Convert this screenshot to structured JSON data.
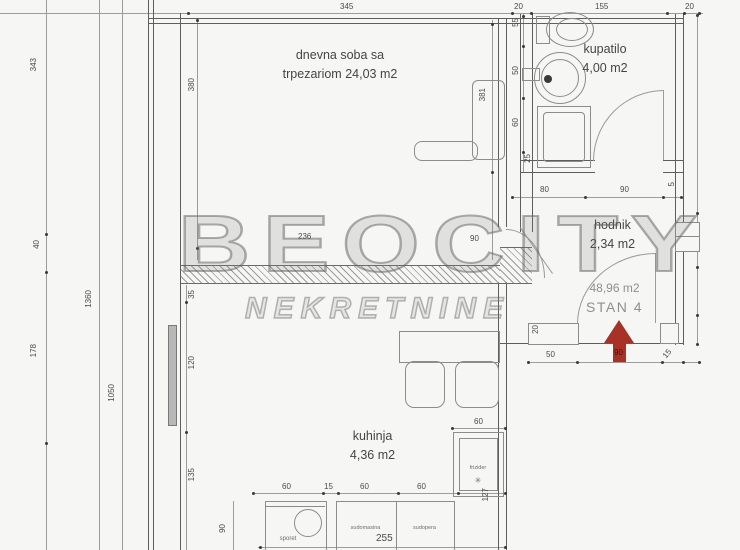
{
  "watermark": {
    "line1": "BEOCITY",
    "line2": "NEKRETNINE"
  },
  "rooms": {
    "living": {
      "name": "dnevna soba sa",
      "area": "trpezariom 24,03 m2"
    },
    "bathroom": {
      "name": "kupatilo",
      "area": "4,00 m2"
    },
    "hall": {
      "name": "hodnik",
      "area": "2,34 m2"
    },
    "kitchen": {
      "name": "kuhinja",
      "area": "4,36 m2"
    }
  },
  "apartment": {
    "total_area": "48,96 m2",
    "unit_label": "STAN 4"
  },
  "fixtures": {
    "stove": "sporet",
    "dishwasher": "sudomasina",
    "sink": "sudopera",
    "fridge": "frizider",
    "fridge_symbol": "✳"
  },
  "dims": {
    "top_345": "345",
    "top_20_left": "20",
    "top_155": "155",
    "top_20_right": "20",
    "left_343": "343",
    "left_40": "40",
    "left_178": "178",
    "left_1360": "1360",
    "left_1050": "1050",
    "liv_380": "380",
    "liv_381": "381",
    "liv_236": "236",
    "liv_90": "90",
    "liv_35": "35",
    "bath_55": "55",
    "bath_50": "50",
    "bath_60": "60",
    "bath_25": "25",
    "hall_80": "80",
    "hall_90": "90",
    "hall_5": "5",
    "kit_120": "120",
    "kit_135": "135",
    "kit_60_1": "60",
    "kit_15": "15",
    "kit_60_2": "60",
    "kit_60_3": "60",
    "kit_60_fridge": "60",
    "kit_127": "127",
    "kit_255": "255",
    "kit_90": "90",
    "entry_50": "50",
    "entry_90": "90",
    "entry_15": "15",
    "entry_20": "20"
  },
  "colors": {
    "arrow_red": "#a83226",
    "wall_gray": "#5e5e5e",
    "dimline_gray": "#9c9c9c"
  }
}
